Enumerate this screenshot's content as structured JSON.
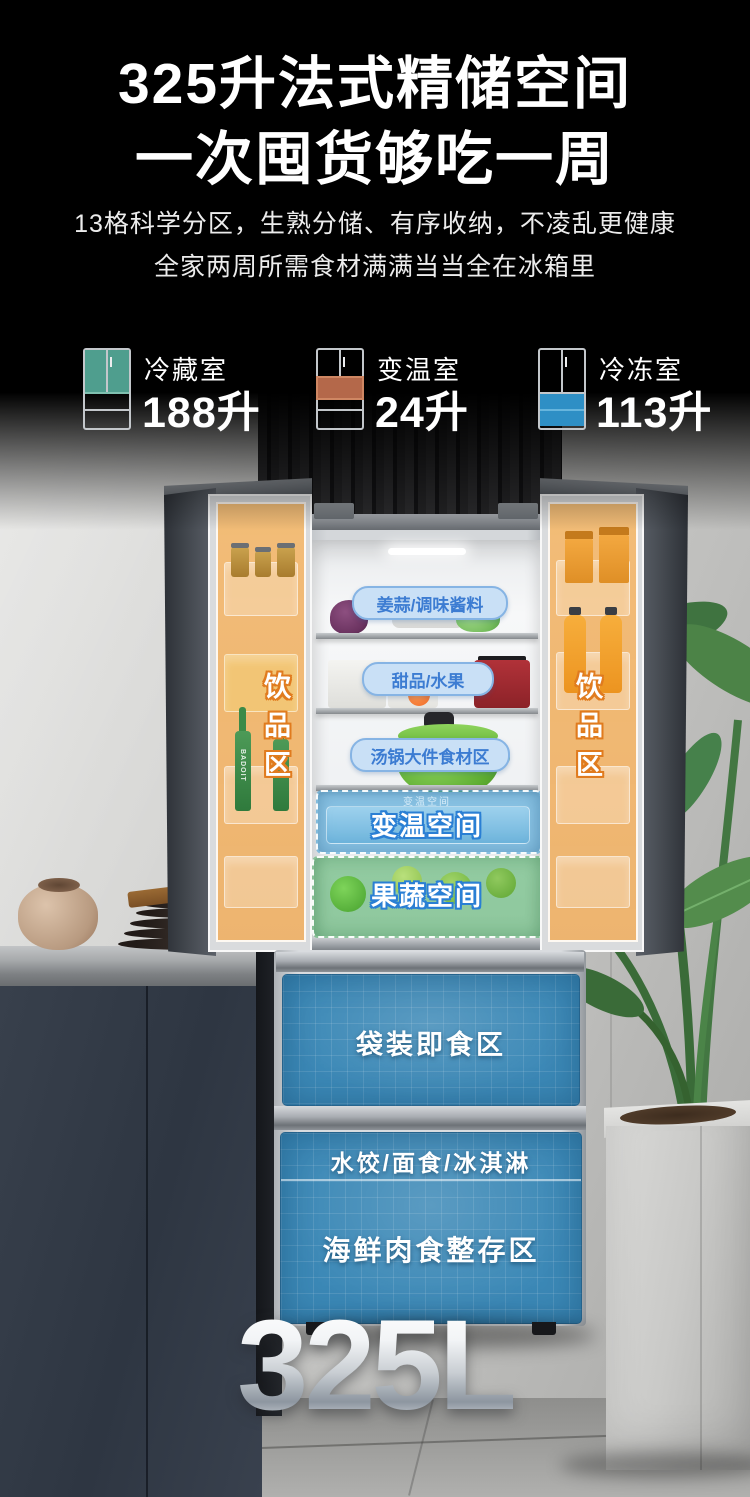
{
  "header": {
    "title_line1": "325升法式精储空间",
    "title_line2": "一次囤货够吃一周",
    "desc_line1": "13格科学分区，生熟分储、有序收纳，不凌乱更健康",
    "desc_line2": "全家两周所需食材满满当当全在冰箱里"
  },
  "specs": [
    {
      "label": "冷藏室",
      "value": "188升",
      "icon": "fridge-fresh-zone-icon",
      "highlight_color": "#4f9e8e"
    },
    {
      "label": "变温室",
      "value": "24升",
      "icon": "fridge-variable-zone-icon",
      "highlight_color": "#b4684a"
    },
    {
      "label": "冷冻室",
      "value": "113升",
      "icon": "fridge-freezer-zone-icon",
      "highlight_color": "#2e8fc5"
    }
  ],
  "fridge": {
    "shelf_labels": [
      "姜蒜/调味酱料",
      "甜品/水果",
      "汤锅大件食材区"
    ],
    "left_door_label": "饮品区",
    "right_door_label": "饮品区",
    "bottle_brand": "BADOIT",
    "variable_drawer": {
      "small_label": "变温空间",
      "label": "变温空间",
      "highlight_color": "#3ea0d8"
    },
    "produce_drawer": {
      "label": "果蔬空间",
      "highlight_color": "#3cac56"
    },
    "freezer_drawer_1": {
      "label": "袋装即食区"
    },
    "freezer_drawer_2": {
      "top_label": "水饺/面食/冰淇淋",
      "label": "海鲜肉食整存区"
    }
  },
  "footer": {
    "capacity": "325L"
  },
  "colors": {
    "door_highlight": "#f3b164",
    "label_pill_bg": "#c9e0f6",
    "label_pill_text": "#3c7cd2",
    "zone_text_outline_blue": "#2a7fd4",
    "zone_text_outline_orange": "#e07b1e",
    "freezer_panel_blue": "#3b88b6"
  }
}
